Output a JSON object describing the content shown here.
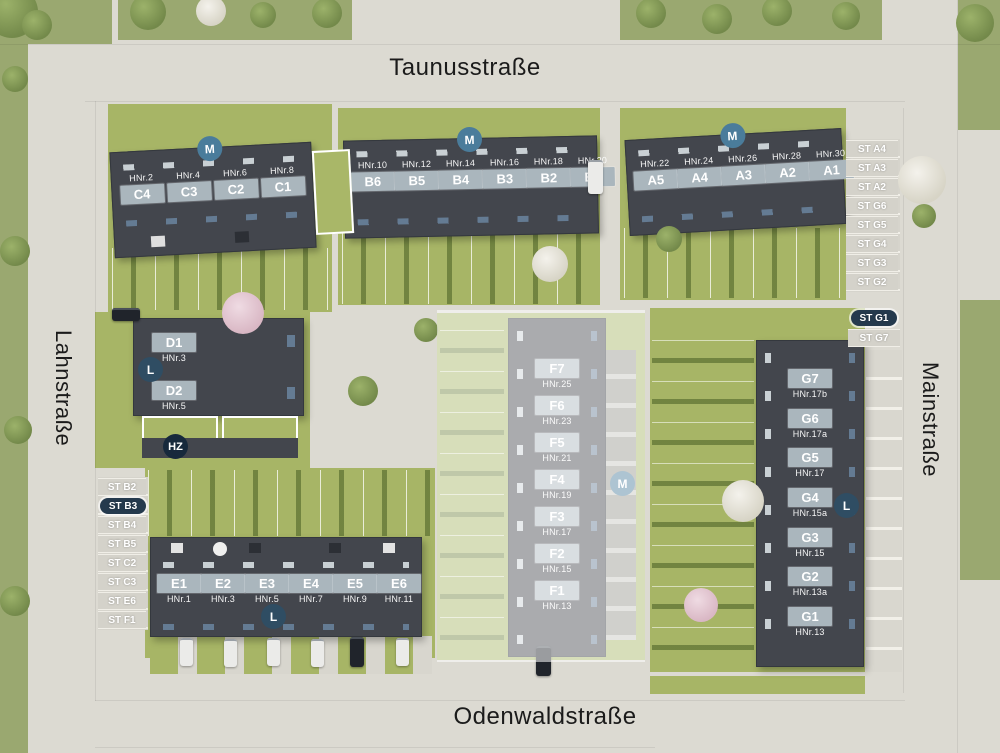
{
  "streets": {
    "top": "Taunusstraße",
    "left": "Lahnstraße",
    "right": "Mainstraße",
    "bottom": "Odenwaldstraße"
  },
  "badges": {
    "m": "M",
    "l": "L",
    "hz": "HZ"
  },
  "buildings": {
    "a": {
      "units": [
        {
          "code": "A5",
          "hnr": "HNr.22"
        },
        {
          "code": "A4",
          "hnr": "HNr.24"
        },
        {
          "code": "A3",
          "hnr": "HNr.26"
        },
        {
          "code": "A2",
          "hnr": "HNr.28"
        },
        {
          "code": "A1",
          "hnr": "HNr.30"
        }
      ]
    },
    "b": {
      "units": [
        {
          "code": "B6",
          "hnr": "HNr.10"
        },
        {
          "code": "B5",
          "hnr": "HNr.12"
        },
        {
          "code": "B4",
          "hnr": "HNr.14"
        },
        {
          "code": "B3",
          "hnr": "HNr.16"
        },
        {
          "code": "B2",
          "hnr": "HNr.18"
        },
        {
          "code": "B1",
          "hnr": "HNr.20"
        }
      ]
    },
    "c": {
      "units": [
        {
          "code": "C4",
          "hnr": "HNr.2"
        },
        {
          "code": "C3",
          "hnr": "HNr.4"
        },
        {
          "code": "C2",
          "hnr": "HNr.6"
        },
        {
          "code": "C1",
          "hnr": "HNr.8"
        }
      ]
    },
    "d": {
      "units": [
        {
          "code": "D1",
          "hnr": "HNr.3"
        },
        {
          "code": "D2",
          "hnr": "HNr.5"
        }
      ]
    },
    "e": {
      "units": [
        {
          "code": "E1",
          "hnr": "HNr.1"
        },
        {
          "code": "E2",
          "hnr": "HNr.3"
        },
        {
          "code": "E3",
          "hnr": "HNr.5"
        },
        {
          "code": "E4",
          "hnr": "HNr.7"
        },
        {
          "code": "E5",
          "hnr": "HNr.9"
        },
        {
          "code": "E6",
          "hnr": "HNr.11"
        }
      ]
    },
    "f": {
      "units": [
        {
          "code": "F7",
          "hnr": "HNr.25"
        },
        {
          "code": "F6",
          "hnr": "HNr.23"
        },
        {
          "code": "F5",
          "hnr": "HNr.21"
        },
        {
          "code": "F4",
          "hnr": "HNr.19"
        },
        {
          "code": "F3",
          "hnr": "HNr.17"
        },
        {
          "code": "F2",
          "hnr": "HNr.15"
        },
        {
          "code": "F1",
          "hnr": "HNr.13"
        }
      ]
    },
    "g": {
      "units": [
        {
          "code": "G7",
          "hnr": "HNr.17b"
        },
        {
          "code": "G6",
          "hnr": "HNr.17a"
        },
        {
          "code": "G5",
          "hnr": "HNr.17"
        },
        {
          "code": "G4",
          "hnr": "HNr.15a"
        },
        {
          "code": "G3",
          "hnr": "HNr.15"
        },
        {
          "code": "G2",
          "hnr": "HNr.13a"
        },
        {
          "code": "G1",
          "hnr": "HNr.13"
        }
      ]
    }
  },
  "parking": {
    "right_top": [
      "ST A4",
      "ST A3",
      "ST A2",
      "ST G6",
      "ST G5",
      "ST G4",
      "ST G3",
      "ST G2"
    ],
    "right_mid": [
      "ST G1",
      "ST G7"
    ],
    "left": [
      "ST B2",
      "ST B3",
      "ST B4",
      "ST B5",
      "ST C2",
      "ST C3",
      "ST E6",
      "ST F1"
    ]
  },
  "colors": {
    "pavement": "#dcdad2",
    "grass": "#a7b566",
    "building": "#43464d",
    "unit_box": "#aab6bd",
    "badge_m": "#4a7c9b",
    "badge_l": "#2f4d63",
    "badge_hz": "#17293c",
    "highlight_pill": "#253a4d"
  }
}
